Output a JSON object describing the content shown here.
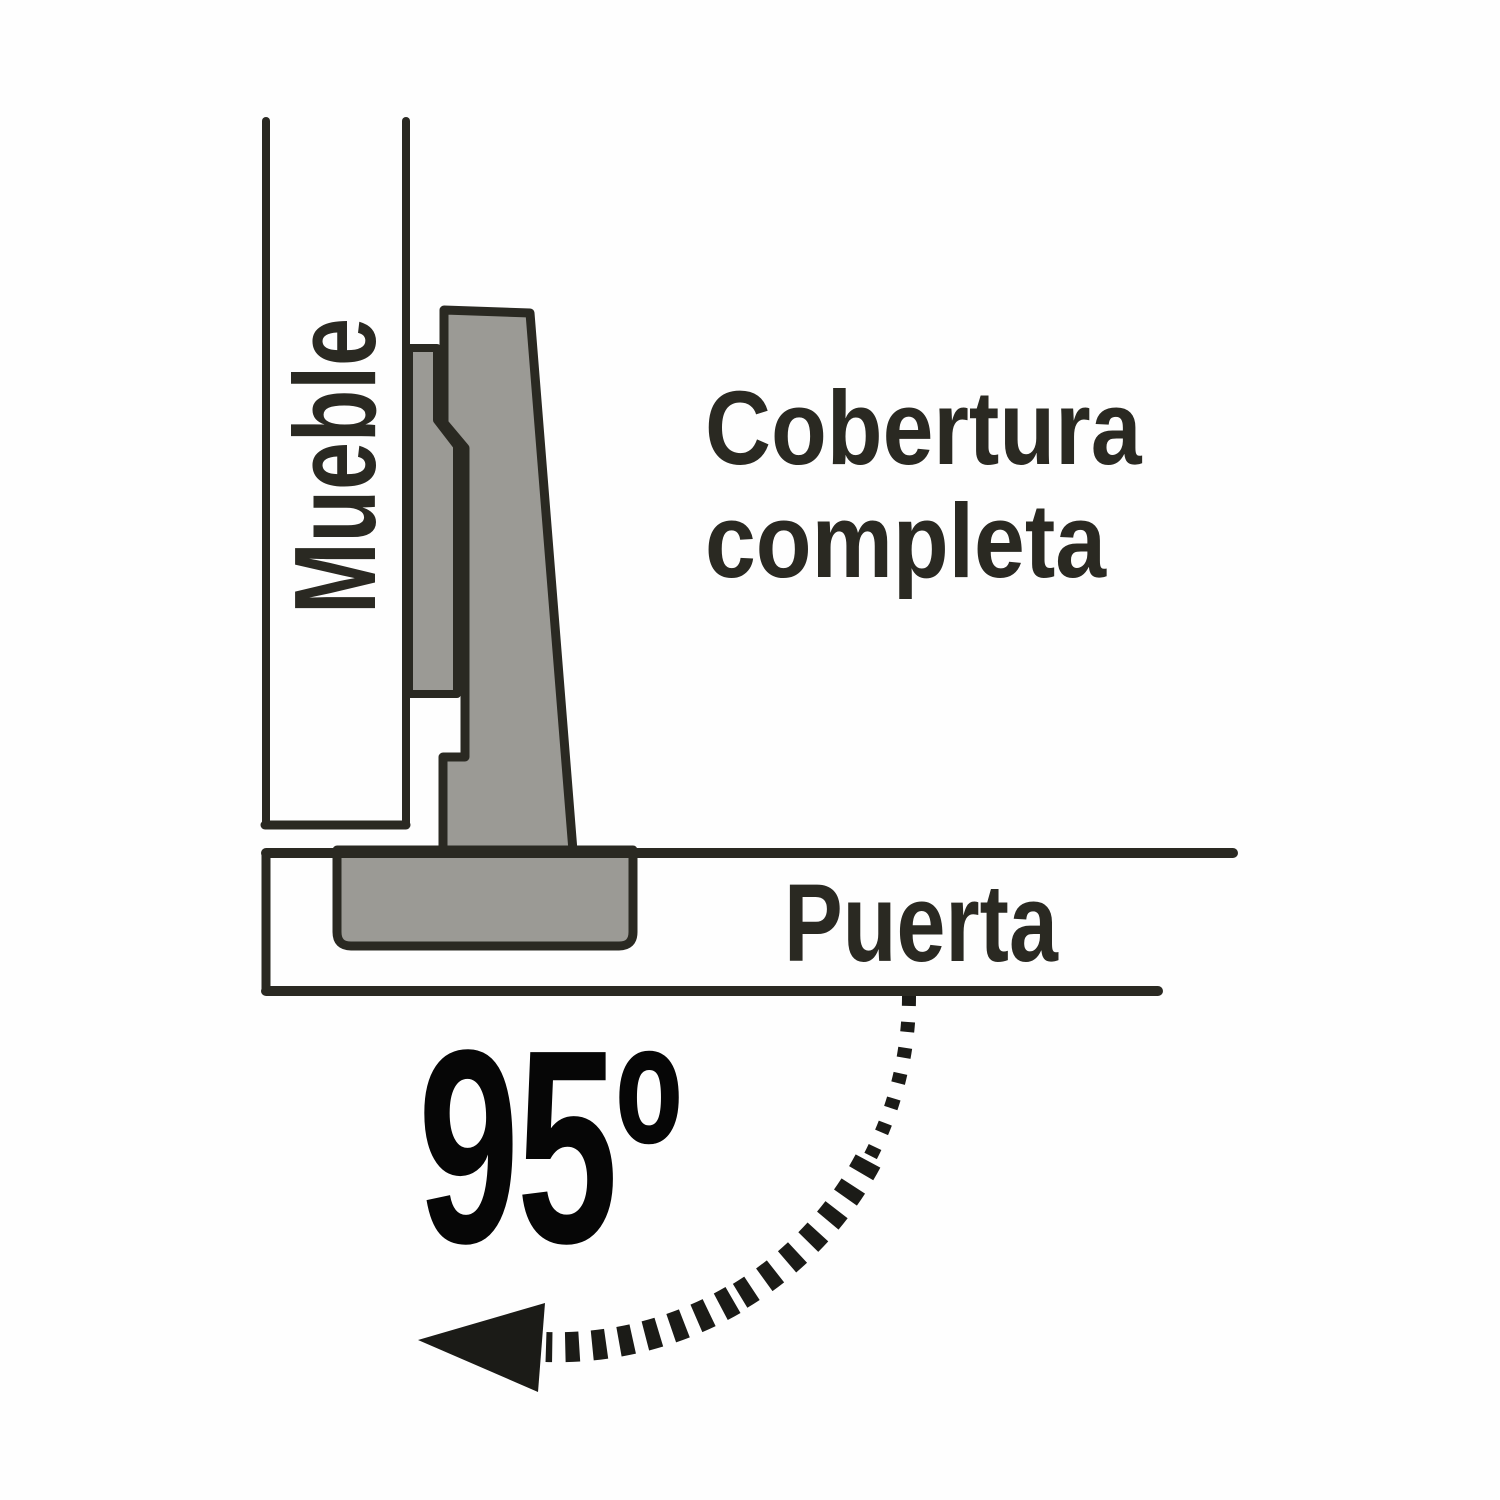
{
  "diagram": {
    "cabinet_label": "Mueble",
    "coverage_label_line1": "Cobertura",
    "coverage_label_line2": "completa",
    "door_label": "Puerta",
    "angle_label": "95º",
    "colors": {
      "background": "#fefefe",
      "outline": "#2a2922",
      "hinge_fill": "#9b9a95",
      "angle_text": "#060606",
      "arrow": "#1b1b17"
    }
  }
}
